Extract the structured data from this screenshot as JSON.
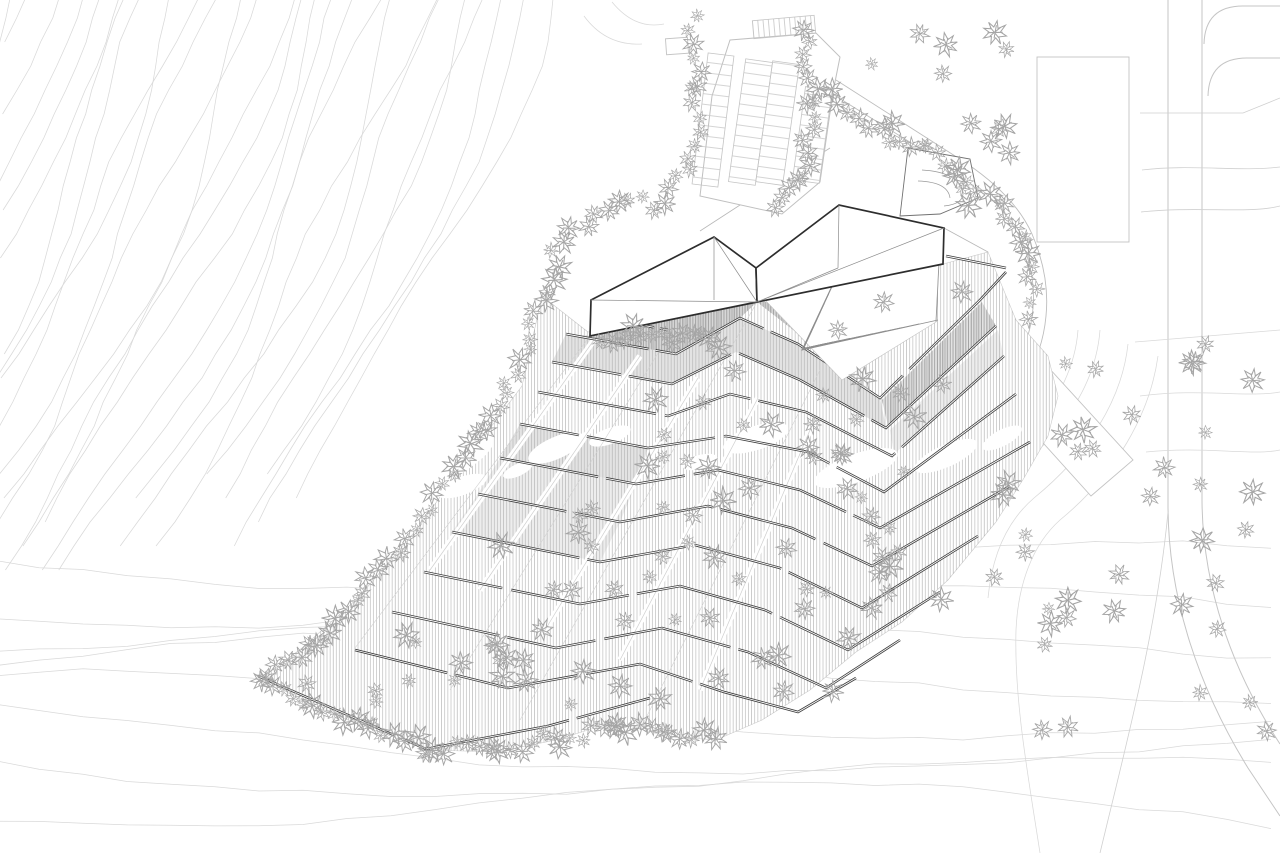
{
  "drawing": {
    "kind": "architectural-site-plan",
    "visible_text": [],
    "layers": [
      {
        "id": "contours",
        "name": "topographic contour lines"
      },
      {
        "id": "roads",
        "name": "roads and curved footpaths"
      },
      {
        "id": "context",
        "name": "neighboring building footprints"
      },
      {
        "id": "terraces",
        "name": "terraced hillside with hatching and retaining walls"
      },
      {
        "id": "amphitheater",
        "name": "stepped amphitheater terraces"
      },
      {
        "id": "building",
        "name": "folded-plate building roof"
      },
      {
        "id": "parking",
        "name": "parking lot with stall rows"
      },
      {
        "id": "vegetation",
        "name": "scribbled tree symbols"
      }
    ]
  },
  "colors": {
    "background": "#ffffff",
    "contour": "#d9d9d9",
    "road": "#c5c5c5",
    "path": "#bdbdbd",
    "context_outline": "#c3c3c3",
    "building_outline": "#2d2d2d",
    "fold_line": "#8c8c8c",
    "retaining_wall": "#3c3c3c",
    "hatch": "#ababab",
    "hatch_dark": "#989898",
    "wash_light": "#ededed",
    "wash_mid": "#e3e3e3",
    "wash_dark": "#d8d8d8",
    "tree": "#a5a5a5"
  }
}
